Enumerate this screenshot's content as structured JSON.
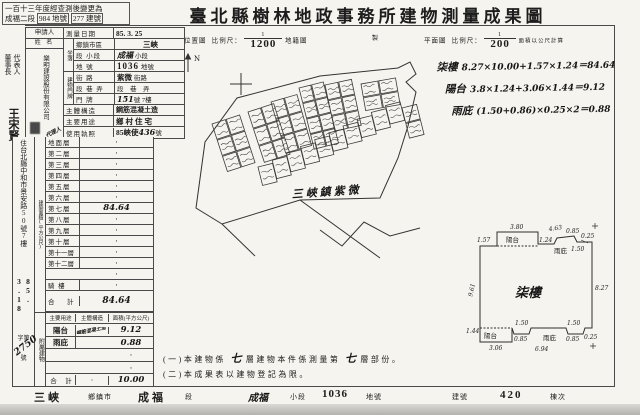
{
  "note": {
    "line1": "一百十三年度經查測後變更為",
    "line2_pre": "成福二段",
    "line2_box1": "984 地號",
    "line2_box2": "277 建號"
  },
  "title": "臺北縣樹林地政事務所建物測量成果圖",
  "left_margin": {
    "rep_title1": "代表人",
    "rep_title2": "董事長",
    "rep_name": "王宋賢"
  },
  "applicant": {
    "header": "申請人",
    "sub": "姓 名",
    "name_col1": "樂明建設",
    "name_col2": "股份有限公司",
    "agent": "代理人",
    "residence_label": "住",
    "address": "台北縣中和市景安路50號7樓",
    "recv_date": "85. 3.18",
    "recv_prefix": "字第",
    "recv_no": "2750",
    "recv_suffix": "號"
  },
  "info": {
    "survey_date_label": "測量日期",
    "survey_date": "85. 3. 25",
    "locate_group": "坐落",
    "town_label": "鄉鎮市區",
    "town": "三峽",
    "section_label": "段 小段",
    "section": "成福",
    "section_suffix": "小段",
    "parcel_label": "地 號",
    "parcel": "1036",
    "parcel_suffix": "地號",
    "door_group": "建物門牌",
    "street_label": "街 路",
    "street": "紫微",
    "street_suffix": "街路",
    "lane_label": "段 巷 弄",
    "lane_value": "段　巷　弄",
    "door_label": "門 牌",
    "door_no": "151",
    "door_suffix": "號 7樓",
    "structure_label": "主體構造",
    "structure": "鋼筋混凝土造",
    "usage_label": "主要用途",
    "usage": "鄉村住宅",
    "license_label": "使用執照",
    "license": "85峽使",
    "license_no": "436",
    "license_suffix": "號"
  },
  "area": {
    "group": "建築面積(平方公尺)",
    "floors": [
      {
        "label": "地面層",
        "value": "·"
      },
      {
        "label": "第二層",
        "value": "·"
      },
      {
        "label": "第三層",
        "value": "·"
      },
      {
        "label": "第四層",
        "value": "·"
      },
      {
        "label": "第五層",
        "value": "·"
      },
      {
        "label": "第六層",
        "value": "·"
      },
      {
        "label": "第七層",
        "value": "84.64"
      },
      {
        "label": "第八層",
        "value": "·"
      },
      {
        "label": "第九層",
        "value": "·"
      },
      {
        "label": "第十層",
        "value": "·"
      },
      {
        "label": "第十一層",
        "value": "·"
      },
      {
        "label": "第十二層",
        "value": "·"
      },
      {
        "label": "",
        "value": "·"
      },
      {
        "label": "騎 樓",
        "value": "·"
      }
    ],
    "total_label": "合　計",
    "total": "84.64"
  },
  "annex": {
    "group": "附屬建物",
    "h1": "主要用途",
    "h2": "主體構造",
    "h3": "面積(平方公尺)",
    "rows": [
      {
        "use": "陽台",
        "structure": "鋼筋混凝土造",
        "area": "9.12"
      },
      {
        "use": "雨庇",
        "structure": "",
        "area": "0.88"
      },
      {
        "use": "",
        "structure": "",
        "area": "·"
      },
      {
        "use": "",
        "structure": "",
        "area": "·"
      }
    ],
    "total_label": "合　計",
    "total_structure": "·",
    "total": "10.00"
  },
  "scales": {
    "loc_label": "位置圖",
    "loc_ratio_label": "比例尺：",
    "loc_num": "1",
    "loc_den": "1200",
    "loc_suffix": "地籍圖",
    "loc_tail": "製",
    "plan_label": "平面圖",
    "plan_ratio_label": "比例尺：",
    "plan_num": "1",
    "plan_den": "200",
    "plan_suffix": "面積以公尺計算"
  },
  "map": {
    "north": "N",
    "label": "三峽鎮紫微"
  },
  "calc": {
    "c1l": "柒樓",
    "c1": "8.27×10.00+1.57×1.24＝84.64",
    "c2l": "陽台",
    "c2": "3.8×1.24+3.06×1.44＝9.12",
    "c3l": "雨庇",
    "c3": "(1.50+0.86)×0.25×2＝0.88"
  },
  "plan": {
    "room": "柒樓",
    "bt": "陽台",
    "bb": "陽台",
    "ct": "雨庇",
    "cb": "雨庇",
    "d1": "1.57",
    "d2": "3.80",
    "d3": "1.24",
    "d4": "4.63",
    "d5": "0.85",
    "d6": "1.50",
    "d7": "0.25",
    "d8": "9.61",
    "d9": "8.27",
    "d10": "1.44",
    "d11": "3.06",
    "d12": "1.50",
    "d13": "0.85",
    "d14": "1.50",
    "d15": "0.85",
    "d16": "0.25",
    "d17": "6.94"
  },
  "notes": {
    "n1a": "(一)本建物係",
    "n1b": "七",
    "n1c": "層建物本件係測量第",
    "n1d": "七",
    "n1e": "層部份。",
    "n2": "(二)本成果表以建物登記為限。"
  },
  "footer": {
    "f1": "三峽",
    "f1l": "鄉鎮市",
    "f2": "成福",
    "f2l": "段",
    "f3": "成福",
    "f3l": "小段",
    "f4": "1036",
    "f4l": "地號",
    "f5l": "建號",
    "f5": "420",
    "f6l": "棟次"
  }
}
